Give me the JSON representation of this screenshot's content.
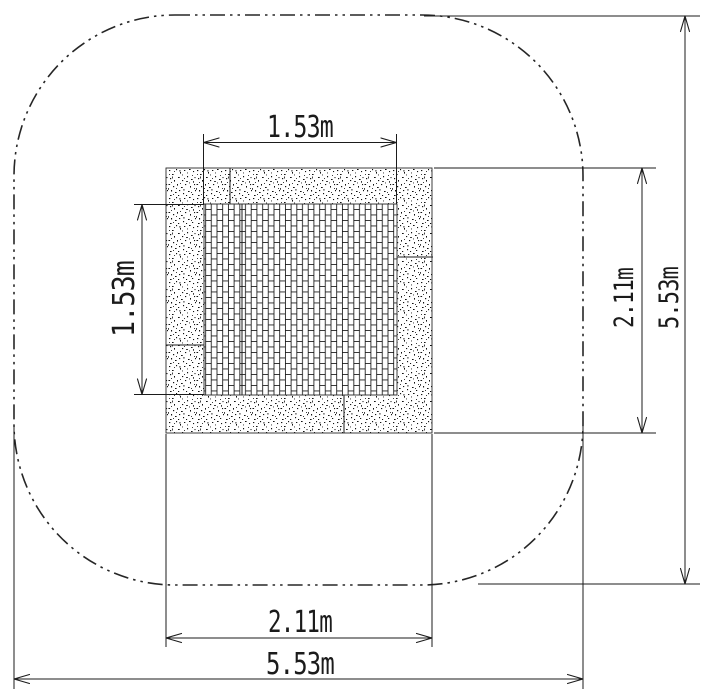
{
  "drawing": {
    "colors": {
      "background": "#ffffff",
      "line": "#1b1b1b"
    },
    "dimensions": {
      "mat_width": {
        "label": "1.53m"
      },
      "mat_height": {
        "label": "1.53m"
      },
      "paver_height": {
        "label": "2.11m"
      },
      "overall_height": {
        "label": "5.53m"
      },
      "paver_width": {
        "label": "2.11m"
      },
      "overall_width": {
        "label": "5.53m"
      }
    }
  }
}
